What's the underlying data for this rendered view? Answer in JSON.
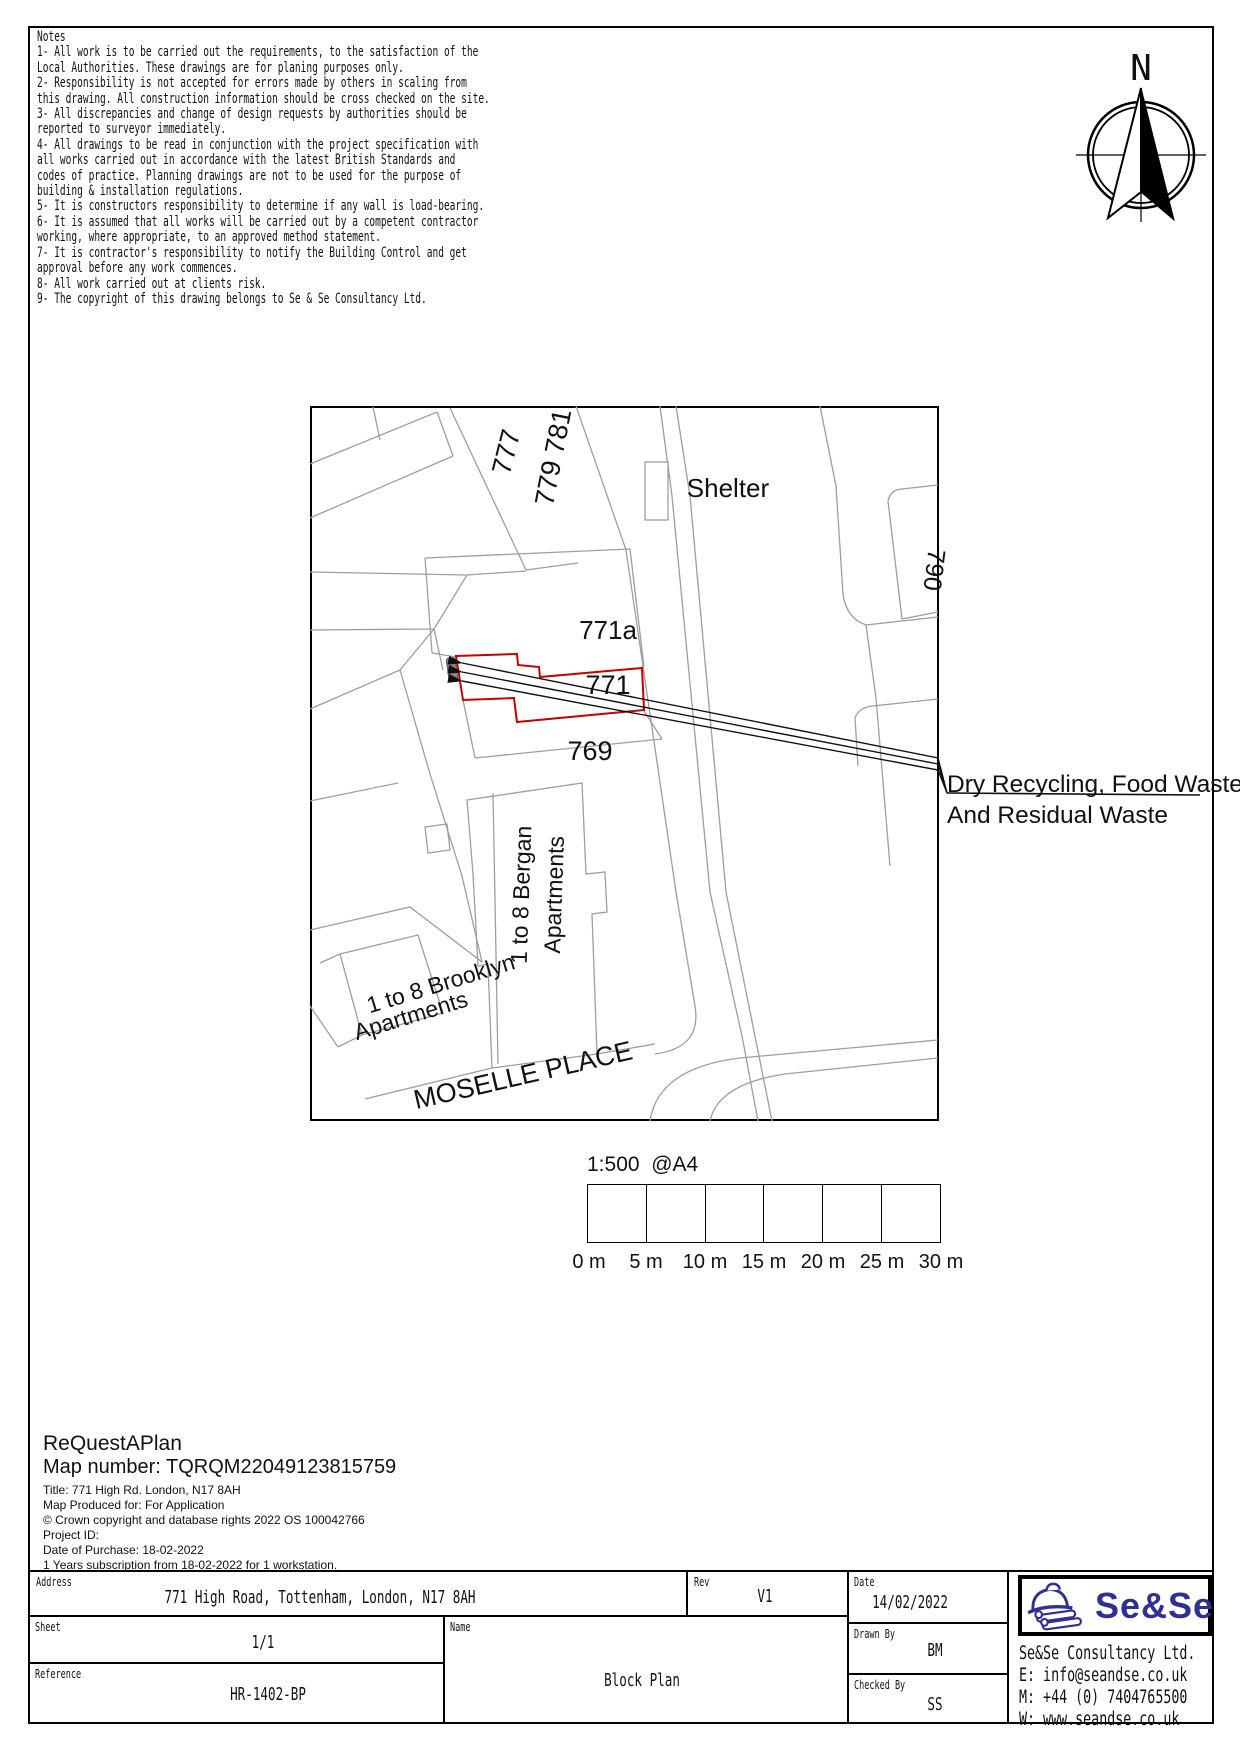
{
  "notes": {
    "title": "Notes",
    "lines": [
      "1- All work is to be carried out the requirements, to the satisfaction of the",
      "Local Authorities. These drawings are for planing purposes only.",
      "2- Responsibility is not accepted for errors made by others in scaling from",
      "this drawing. All construction information should be cross checked on the site.",
      "3- All discrepancies and change of design requests by authorities should be",
      "reported to surveyor immediately.",
      "4- All drawings to be read in conjunction with the project specification with",
      "all works carried out in accordance with the latest British Standards and",
      "codes of practice. Planning drawings are not to be used for the purpose of",
      "building & installation regulations.",
      "5- It is constructors responsibility to determine if any wall is load-bearing.",
      "6- It is assumed that all works will be carried out by a competent contractor",
      "working, where appropriate, to an approved method statement.",
      "7- It is contractor's responsibility to notify the Building Control and get",
      "approval before any work commences.",
      "8- All work carried out at clients risk.",
      "9- The copyright of this drawing belongs to Se & Se Consultancy Ltd."
    ]
  },
  "compass": {
    "label": "N"
  },
  "map": {
    "labels": {
      "b777": "777",
      "b779": "779 781",
      "shelter": "Shelter",
      "b790": "790",
      "b771a": "771a",
      "b771": "771",
      "b769": "769",
      "bergan1": "1 to 8 Bergan",
      "bergan2": "Apartments",
      "brooklyn1": "1 to 8 Brooklyn",
      "brooklyn2": "Apartments",
      "street": "MOSELLE PLACE"
    },
    "annotation": {
      "line1": "Dry Recycling, Food Waste",
      "line2": "And Residual Waste"
    }
  },
  "scale_bar": {
    "ratio": "1:500  @A4",
    "ticks": [
      "0 m",
      "5 m",
      "10 m",
      "15 m",
      "20 m",
      "25 m",
      "30 m"
    ]
  },
  "map_info": {
    "brand": "ReQuestAPlan",
    "map_number": "Map number: TQRQM22049123815759",
    "details": [
      "Title: 771 High Rd. London, N17 8AH",
      "Map Produced for: For Application",
      "© Crown copyright and database rights 2022 OS 100042766",
      "Project ID:",
      "Date of Purchase: 18-02-2022",
      "1 Years subscription from 18-02-2022 for 1 workstation."
    ]
  },
  "title_block": {
    "address": {
      "label": "Address",
      "value": "771 High Road, Tottenham, London, N17 8AH"
    },
    "sheet": {
      "label": "Sheet",
      "value": "1/1"
    },
    "reference": {
      "label": "Reference",
      "value": "HR-1402-BP"
    },
    "rev": {
      "label": "Rev",
      "value": "V1"
    },
    "name": {
      "label": "Name",
      "value": "Block Plan"
    },
    "date": {
      "label": "Date",
      "value": "14/02/2022"
    },
    "drawn_by": {
      "label": "Drawn By",
      "value": "BM"
    },
    "checked_by": {
      "label": "Checked By",
      "value": "SS"
    },
    "company": {
      "logo_text": "Se&Se",
      "name": "Se&Se Consultancy Ltd.",
      "email": "E: info@seandse.co.uk",
      "mobile": "M: +44 (0) 7404765500",
      "web": "W: www.seandse.co.uk"
    }
  },
  "colors": {
    "parcel_gray": "#9e9e9e",
    "site_red": "#c40000",
    "logo_navy": "#2e3192",
    "bin_gray": "#8a8a8a"
  }
}
